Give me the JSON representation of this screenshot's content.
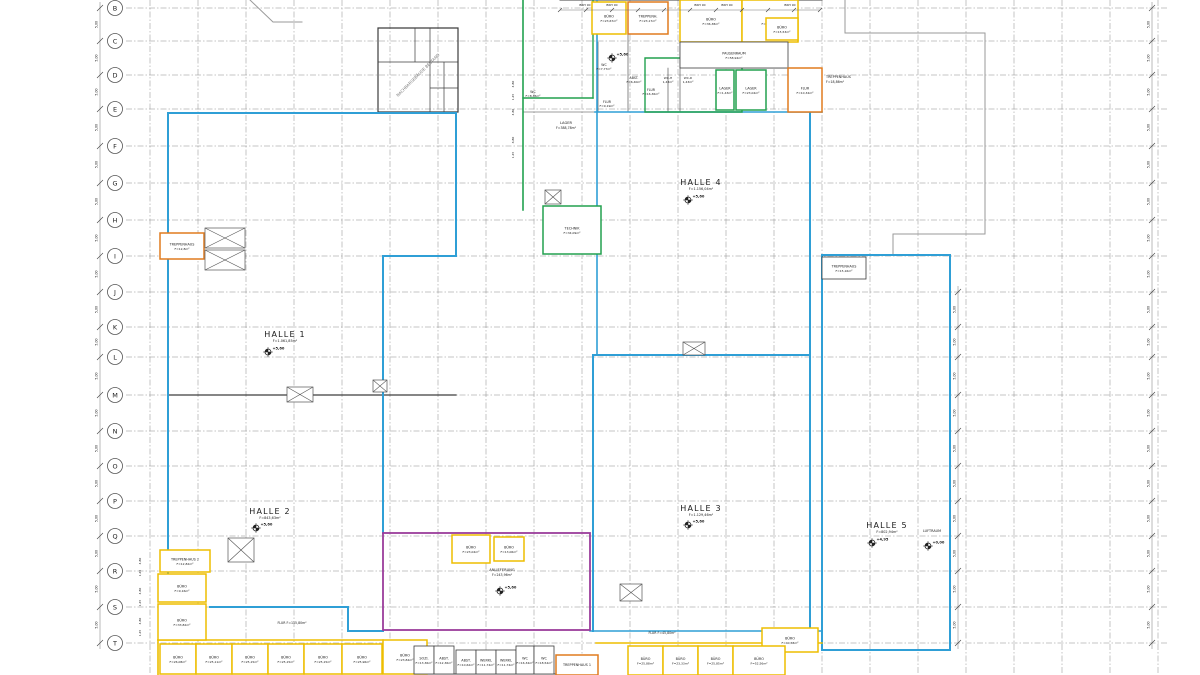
{
  "colors": {
    "blue": "#2f9fd6",
    "green": "#22a14f",
    "orange": "#e07b1f",
    "yellow": "#edbe00",
    "magenta": "#9b3d9b",
    "wall": "#3d3d3d",
    "gray": "#9a9a9a",
    "grid": "#8c8c8c",
    "text": "#1a1a1a"
  },
  "grid": {
    "dim_label": "5,00",
    "rows": [
      {
        "label": "B",
        "y": 8
      },
      {
        "label": "C",
        "y": 41
      },
      {
        "label": "D",
        "y": 75
      },
      {
        "label": "E",
        "y": 109
      },
      {
        "label": "F",
        "y": 146
      },
      {
        "label": "G",
        "y": 183
      },
      {
        "label": "H",
        "y": 220
      },
      {
        "label": "I",
        "y": 256
      },
      {
        "label": "J",
        "y": 292
      },
      {
        "label": "K",
        "y": 327
      },
      {
        "label": "L",
        "y": 357
      },
      {
        "label": "M",
        "y": 395
      },
      {
        "label": "N",
        "y": 431
      },
      {
        "label": "O",
        "y": 466
      },
      {
        "label": "P",
        "y": 501
      },
      {
        "label": "Q",
        "y": 536
      },
      {
        "label": "R",
        "y": 571
      },
      {
        "label": "S",
        "y": 607
      },
      {
        "label": "T",
        "y": 643
      }
    ]
  },
  "halls": [
    {
      "name": "HALLE 1",
      "area": "F=1.061,85m²",
      "elev": "+5,60",
      "x": 285,
      "y": 337,
      "ex": 268,
      "ey": 352
    },
    {
      "name": "HALLE 2",
      "area": "F=843,63m²",
      "elev": "+5,60",
      "x": 270,
      "y": 514,
      "ex": 256,
      "ey": 528
    },
    {
      "name": "HALLE 3",
      "area": "F=1.129,46m²",
      "elev": "+5,60",
      "x": 701,
      "y": 511,
      "ex": 688,
      "ey": 525
    },
    {
      "name": "HALLE 4",
      "area": "F=1.156,04m²",
      "elev": "+5,60",
      "x": 701,
      "y": 185,
      "ex": 688,
      "ey": 200
    },
    {
      "name": "HALLE 5",
      "area": "F=802,94m²",
      "elev": "+4,95",
      "x": 887,
      "y": 528,
      "ex": 872,
      "ey": 543
    }
  ],
  "elev_markers": [
    {
      "t": "+5,60",
      "x": 612,
      "y": 58
    },
    {
      "t": "+5,60",
      "x": 500,
      "y": 591
    },
    {
      "t": "+0,00",
      "x": 928,
      "y": 546
    }
  ],
  "rooms": [
    {
      "name": "BÜRO",
      "area": "F=23,67m²",
      "x": 592,
      "y": 2,
      "w": 34,
      "h": 32,
      "c": "yellow"
    },
    {
      "name": "TREPPENH.",
      "area": "F=23,17m²",
      "x": 628,
      "y": 2,
      "w": 40,
      "h": 32,
      "c": "orange"
    },
    {
      "name": "BÜRO",
      "area": "F=36,38m²",
      "x": 680,
      "y": 0,
      "w": 62,
      "h": 42,
      "c": "yellow"
    },
    {
      "name": "FLUR",
      "area": "F=63,35m²",
      "x": 742,
      "y": 0,
      "w": 56,
      "h": 42,
      "c": "yellow"
    },
    {
      "name": "BÜRO",
      "area": "F=15,53m²",
      "x": 766,
      "y": 18,
      "w": 32,
      "h": 22,
      "c": "yellow"
    },
    {
      "name": "PAUSENRAUM",
      "area": "F=58,94m²",
      "x": 680,
      "y": 42,
      "w": 108,
      "h": 26,
      "c": "wall"
    },
    {
      "name": "LAGER",
      "area": "F=1,43m²",
      "x": 716,
      "y": 70,
      "w": 18,
      "h": 40,
      "c": "green"
    },
    {
      "name": "LAGER",
      "area": "F=23,04m²",
      "x": 736,
      "y": 70,
      "w": 30,
      "h": 40,
      "c": "green"
    },
    {
      "name": "FLUR",
      "area": "F=10,34m²",
      "x": 788,
      "y": 68,
      "w": 34,
      "h": 44,
      "c": "orange"
    },
    {
      "name": "TECHNIK",
      "area": "F=34,09m²",
      "x": 543,
      "y": 206,
      "w": 58,
      "h": 48,
      "c": "green"
    },
    {
      "name": "TREPPENHAUS",
      "area": "F=12,8m²",
      "x": 160,
      "y": 233,
      "w": 44,
      "h": 26,
      "c": "orange"
    },
    {
      "name": "TREPPENHAUS",
      "area": "F=15,16m²",
      "x": 822,
      "y": 257,
      "w": 44,
      "h": 22,
      "c": "wall"
    },
    {
      "name": "BÜRO",
      "area": "F=23,04m²",
      "x": 452,
      "y": 535,
      "w": 38,
      "h": 28,
      "c": "yellow"
    },
    {
      "name": "BÜRO",
      "area": "F=13,06m²",
      "x": 494,
      "y": 537,
      "w": 30,
      "h": 24,
      "c": "yellow"
    },
    {
      "name": "",
      "area": "",
      "x": 383,
      "y": 533,
      "w": 207,
      "h": 97,
      "c": "magenta",
      "open": true
    },
    {
      "name": "TREPPENHAUS 2",
      "area": "F=12,82m²",
      "x": 160,
      "y": 550,
      "w": 50,
      "h": 22,
      "c": "yellow"
    },
    {
      "name": "BÜRO",
      "area": "F=9,16m²",
      "x": 158,
      "y": 574,
      "w": 48,
      "h": 28,
      "c": "yellow"
    },
    {
      "name": "BÜRO",
      "area": "F=33,82m²",
      "x": 158,
      "y": 604,
      "w": 48,
      "h": 36,
      "c": "yellow"
    },
    {
      "name": "BÜRO",
      "area": "F=26,08m²",
      "x": 160,
      "y": 644,
      "w": 36,
      "h": 30,
      "c": "yellow"
    },
    {
      "name": "BÜRO",
      "area": "F=25,11m²",
      "x": 196,
      "y": 644,
      "w": 36,
      "h": 30,
      "c": "yellow"
    },
    {
      "name": "BÜRO",
      "area": "F=25,15m²",
      "x": 232,
      "y": 644,
      "w": 36,
      "h": 30,
      "c": "yellow"
    },
    {
      "name": "BÜRO",
      "area": "F=25,15m²",
      "x": 268,
      "y": 644,
      "w": 36,
      "h": 30,
      "c": "yellow"
    },
    {
      "name": "BÜRO",
      "area": "F=25,15m²",
      "x": 304,
      "y": 644,
      "w": 38,
      "h": 30,
      "c": "yellow"
    },
    {
      "name": "BÜRO",
      "area": "F=25,96m²",
      "x": 342,
      "y": 644,
      "w": 40,
      "h": 30,
      "c": "yellow"
    },
    {
      "name": "BÜRO",
      "area": "F=23,84m²",
      "x": 383,
      "y": 640,
      "w": 44,
      "h": 34,
      "c": "yellow"
    },
    {
      "name": "SOZI.",
      "area": "F=13,36m²",
      "x": 414,
      "y": 646,
      "w": 20,
      "h": 28,
      "c": "wall"
    },
    {
      "name": "ABST.",
      "area": "F=12,36m²",
      "x": 434,
      "y": 646,
      "w": 20,
      "h": 28,
      "c": "wall"
    },
    {
      "name": "ABST.",
      "area": "F=10,62m²",
      "x": 456,
      "y": 650,
      "w": 20,
      "h": 24,
      "c": "wall"
    },
    {
      "name": "WERKL",
      "area": "F=11,74m²",
      "x": 476,
      "y": 650,
      "w": 20,
      "h": 24,
      "c": "wall"
    },
    {
      "name": "WERKL",
      "area": "F=11,74m²",
      "x": 496,
      "y": 650,
      "w": 20,
      "h": 24,
      "c": "wall"
    },
    {
      "name": "WC",
      "area": "F=16,34m²",
      "x": 516,
      "y": 646,
      "w": 18,
      "h": 28,
      "c": "wall"
    },
    {
      "name": "WC",
      "area": "F=18,54m²",
      "x": 534,
      "y": 646,
      "w": 20,
      "h": 28,
      "c": "wall"
    },
    {
      "name": "TREPPENHAUS 1",
      "area": "",
      "x": 556,
      "y": 655,
      "w": 42,
      "h": 20,
      "c": "orange"
    },
    {
      "name": "BÜRO",
      "area": "F=40,58m²",
      "x": 762,
      "y": 628,
      "w": 56,
      "h": 24,
      "c": "yellow"
    },
    {
      "name": "BÜRO",
      "area": "F=25,88m²",
      "x": 628,
      "y": 646,
      "w": 35,
      "h": 29,
      "c": "yellow"
    },
    {
      "name": "BÜRO",
      "area": "F=23,33m²",
      "x": 663,
      "y": 646,
      "w": 35,
      "h": 29,
      "c": "yellow"
    },
    {
      "name": "BÜRO",
      "area": "F=25,85m²",
      "x": 698,
      "y": 646,
      "w": 35,
      "h": 29,
      "c": "yellow"
    },
    {
      "name": "BÜRO",
      "area": "F=52,56m²",
      "x": 733,
      "y": 646,
      "w": 52,
      "h": 29,
      "c": "yellow"
    }
  ],
  "labels": [
    {
      "t": "NACHBARGEBÄUDE BESTAND",
      "x": 419,
      "y": 76,
      "s": 4,
      "r": -45
    },
    {
      "t": "LAGER",
      "x": 566,
      "y": 124,
      "s": 3.6
    },
    {
      "t": "F=388,78m²",
      "x": 566,
      "y": 129,
      "s": 3.2
    },
    {
      "t": "TREPPENHAUS",
      "x": 826,
      "y": 78,
      "s": 3.4,
      "a": "start"
    },
    {
      "t": "F=18,86m²",
      "x": 826,
      "y": 83,
      "s": 3.2,
      "a": "start"
    },
    {
      "t": "ANLIEFERUNG",
      "x": 502,
      "y": 571,
      "s": 3.6
    },
    {
      "t": "F=243,96m²",
      "x": 502,
      "y": 576,
      "s": 3.2
    },
    {
      "t": "FLUR F=115,80m²",
      "x": 292,
      "y": 624,
      "s": 3.2
    },
    {
      "t": "FLUR F=45,80m²",
      "x": 662,
      "y": 634,
      "s": 3.2
    },
    {
      "t": "LUFTRAUM",
      "x": 932,
      "y": 532,
      "s": 3.4
    },
    {
      "t": "WC",
      "x": 604,
      "y": 66,
      "s": 3.2
    },
    {
      "t": "F=7,77m²",
      "x": 604,
      "y": 70,
      "s": 3
    },
    {
      "t": "ABST.",
      "x": 634,
      "y": 79,
      "s": 3.2
    },
    {
      "t": "F=6,40m²",
      "x": 634,
      "y": 83,
      "s": 3
    },
    {
      "t": "FLUR",
      "x": 651,
      "y": 91,
      "s": 3.2
    },
    {
      "t": "F=16,36m²",
      "x": 651,
      "y": 95,
      "s": 3
    },
    {
      "t": "FLUR",
      "x": 607,
      "y": 103,
      "s": 3.2
    },
    {
      "t": "F=9,19m²",
      "x": 607,
      "y": 107,
      "s": 3
    },
    {
      "t": "WC-H",
      "x": 668,
      "y": 79,
      "s": 3
    },
    {
      "t": "1,43m²",
      "x": 668,
      "y": 83,
      "s": 3
    },
    {
      "t": "WC-D",
      "x": 688,
      "y": 79,
      "s": 3
    },
    {
      "t": "1,43m²",
      "x": 688,
      "y": 83,
      "s": 3
    },
    {
      "t": "WC",
      "x": 533,
      "y": 93,
      "s": 3.2
    },
    {
      "t": "F=8,35m²",
      "x": 533,
      "y": 97,
      "s": 3
    },
    {
      "t": "BRH 90",
      "x": 585,
      "y": 6,
      "s": 3
    },
    {
      "t": "BRH 90",
      "x": 612,
      "y": 6,
      "s": 3
    },
    {
      "t": "BRH 90",
      "x": 700,
      "y": 6,
      "s": 3
    },
    {
      "t": "BRH 90",
      "x": 727,
      "y": 6,
      "s": 3
    },
    {
      "t": "BRH 90",
      "x": 790,
      "y": 6,
      "s": 3
    },
    {
      "t": "4,80",
      "x": 141,
      "y": 561,
      "s": 3,
      "r": -90
    },
    {
      "t": "1,45",
      "x": 141,
      "y": 573,
      "s": 3,
      "r": -90
    },
    {
      "t": "4,80",
      "x": 141,
      "y": 591,
      "s": 3,
      "r": -90
    },
    {
      "t": "1,45",
      "x": 141,
      "y": 603,
      "s": 3,
      "r": -90
    },
    {
      "t": "4,80",
      "x": 141,
      "y": 621,
      "s": 3,
      "r": -90
    },
    {
      "t": "1,45",
      "x": 141,
      "y": 633,
      "s": 3,
      "r": -90
    },
    {
      "t": "4,80",
      "x": 514,
      "y": 84,
      "s": 3,
      "r": -90
    },
    {
      "t": "1,45",
      "x": 514,
      "y": 97,
      "s": 3,
      "r": -90
    },
    {
      "t": "4,80",
      "x": 514,
      "y": 112,
      "s": 3,
      "r": -90
    },
    {
      "t": "6,80",
      "x": 514,
      "y": 140,
      "s": 3,
      "r": -90
    },
    {
      "t": "1,45",
      "x": 514,
      "y": 155,
      "s": 3,
      "r": -90
    }
  ]
}
